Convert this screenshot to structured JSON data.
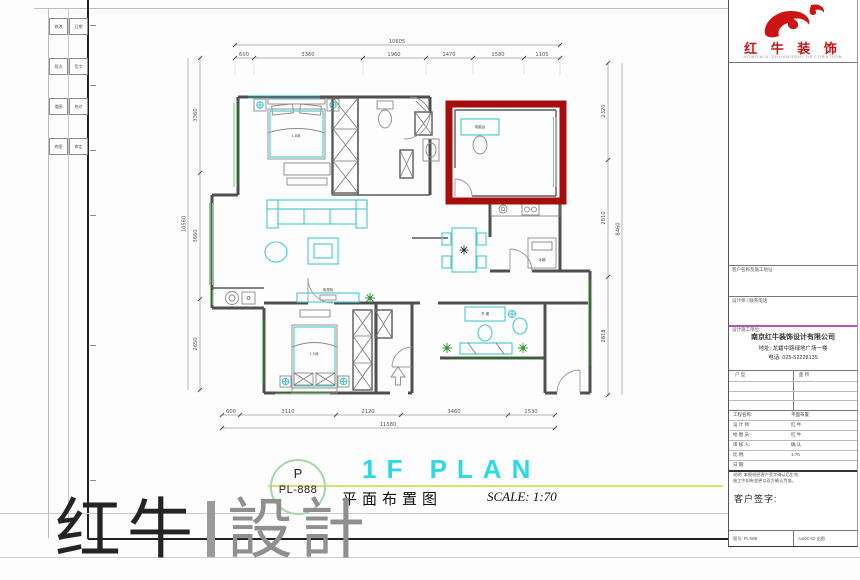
{
  "colors": {
    "accent_cyan": "#2bd9e8",
    "furniture_cyan": "#45c9cf",
    "window_green": "#8cc88c",
    "plant_green": "#3f9b3f",
    "highlight_red": "#a80d0d",
    "brand_red": "#cc1414",
    "divider_magenta": "#b553b5",
    "circle_green": "#a5d6a5",
    "underline_yellow": "#dede6a",
    "wall_gray": "#4f4f4f"
  },
  "fold_strip": {
    "rows": [
      [
        "修改",
        "日期"
      ],
      [
        "版次",
        "签字"
      ],
      [
        "描图",
        "校对"
      ],
      [
        "底图",
        "审定"
      ]
    ]
  },
  "plan": {
    "dim_top": {
      "total": "10605",
      "segments": [
        "600",
        "3360",
        "1960",
        "1470",
        "1580",
        "1105"
      ]
    },
    "dim_bottom": {
      "total": "11580",
      "segments": [
        "600",
        "3110",
        "2120",
        "3460",
        "1530"
      ]
    },
    "dim_left": {
      "total": "10560",
      "segments": [
        "3360",
        "3660",
        "2650"
      ]
    },
    "dim_right": {
      "total": "8460",
      "segments": [
        "2320",
        "2810",
        "2818"
      ]
    },
    "labels": {
      "master_bed": "1.8床",
      "second_bed": "1.5床",
      "tv_cabinet": "电视柜",
      "desk_red_room": "电脑台",
      "desk_leisure": "书 桌",
      "fridge": "冰箱"
    }
  },
  "title_area": {
    "letter": "P",
    "code": "PL-888",
    "title_en": "1F PLAN",
    "title_cn": "平面布置图",
    "scale_text": "SCALE: 1:70"
  },
  "watermark": {
    "left": "红牛",
    "right": "設計"
  },
  "titleblock": {
    "brand": "红 牛 装 饰",
    "tagline": "HONGNIU ZHUANGSHI DECORATION",
    "client_row_label": "客户名称及施工地址:",
    "designer_row_label": "设计师 / 联系电话:",
    "company_heading": "设计施工单位:",
    "company_lines": [
      "南京红牛装饰设计有限公司",
      "地址: 龙蟠中路绿地广场一楼",
      "电话: 025-52228135"
    ],
    "table_headers": [
      "户 型",
      "面 积"
    ],
    "fields": [
      {
        "label": "工程名称:",
        "value": "平面布置"
      },
      {
        "label": "设 计 师:",
        "value": "红 牛"
      },
      {
        "label": "绘 图 员:",
        "value": "红 牛"
      },
      {
        "label": "审 核 人:",
        "value": "确 认"
      },
      {
        "label": "比 例:",
        "value": "1:70"
      },
      {
        "label": "日 期:",
        "value": ""
      }
    ],
    "note_lines": [
      "说明: 本图纸经客户签字确认后生效,",
      "施工中如有变更以双方确认为准。"
    ],
    "signature_label": "客户签字:",
    "footer_cells": [
      "图号: PL-888",
      "AutoCAD 出图"
    ]
  }
}
